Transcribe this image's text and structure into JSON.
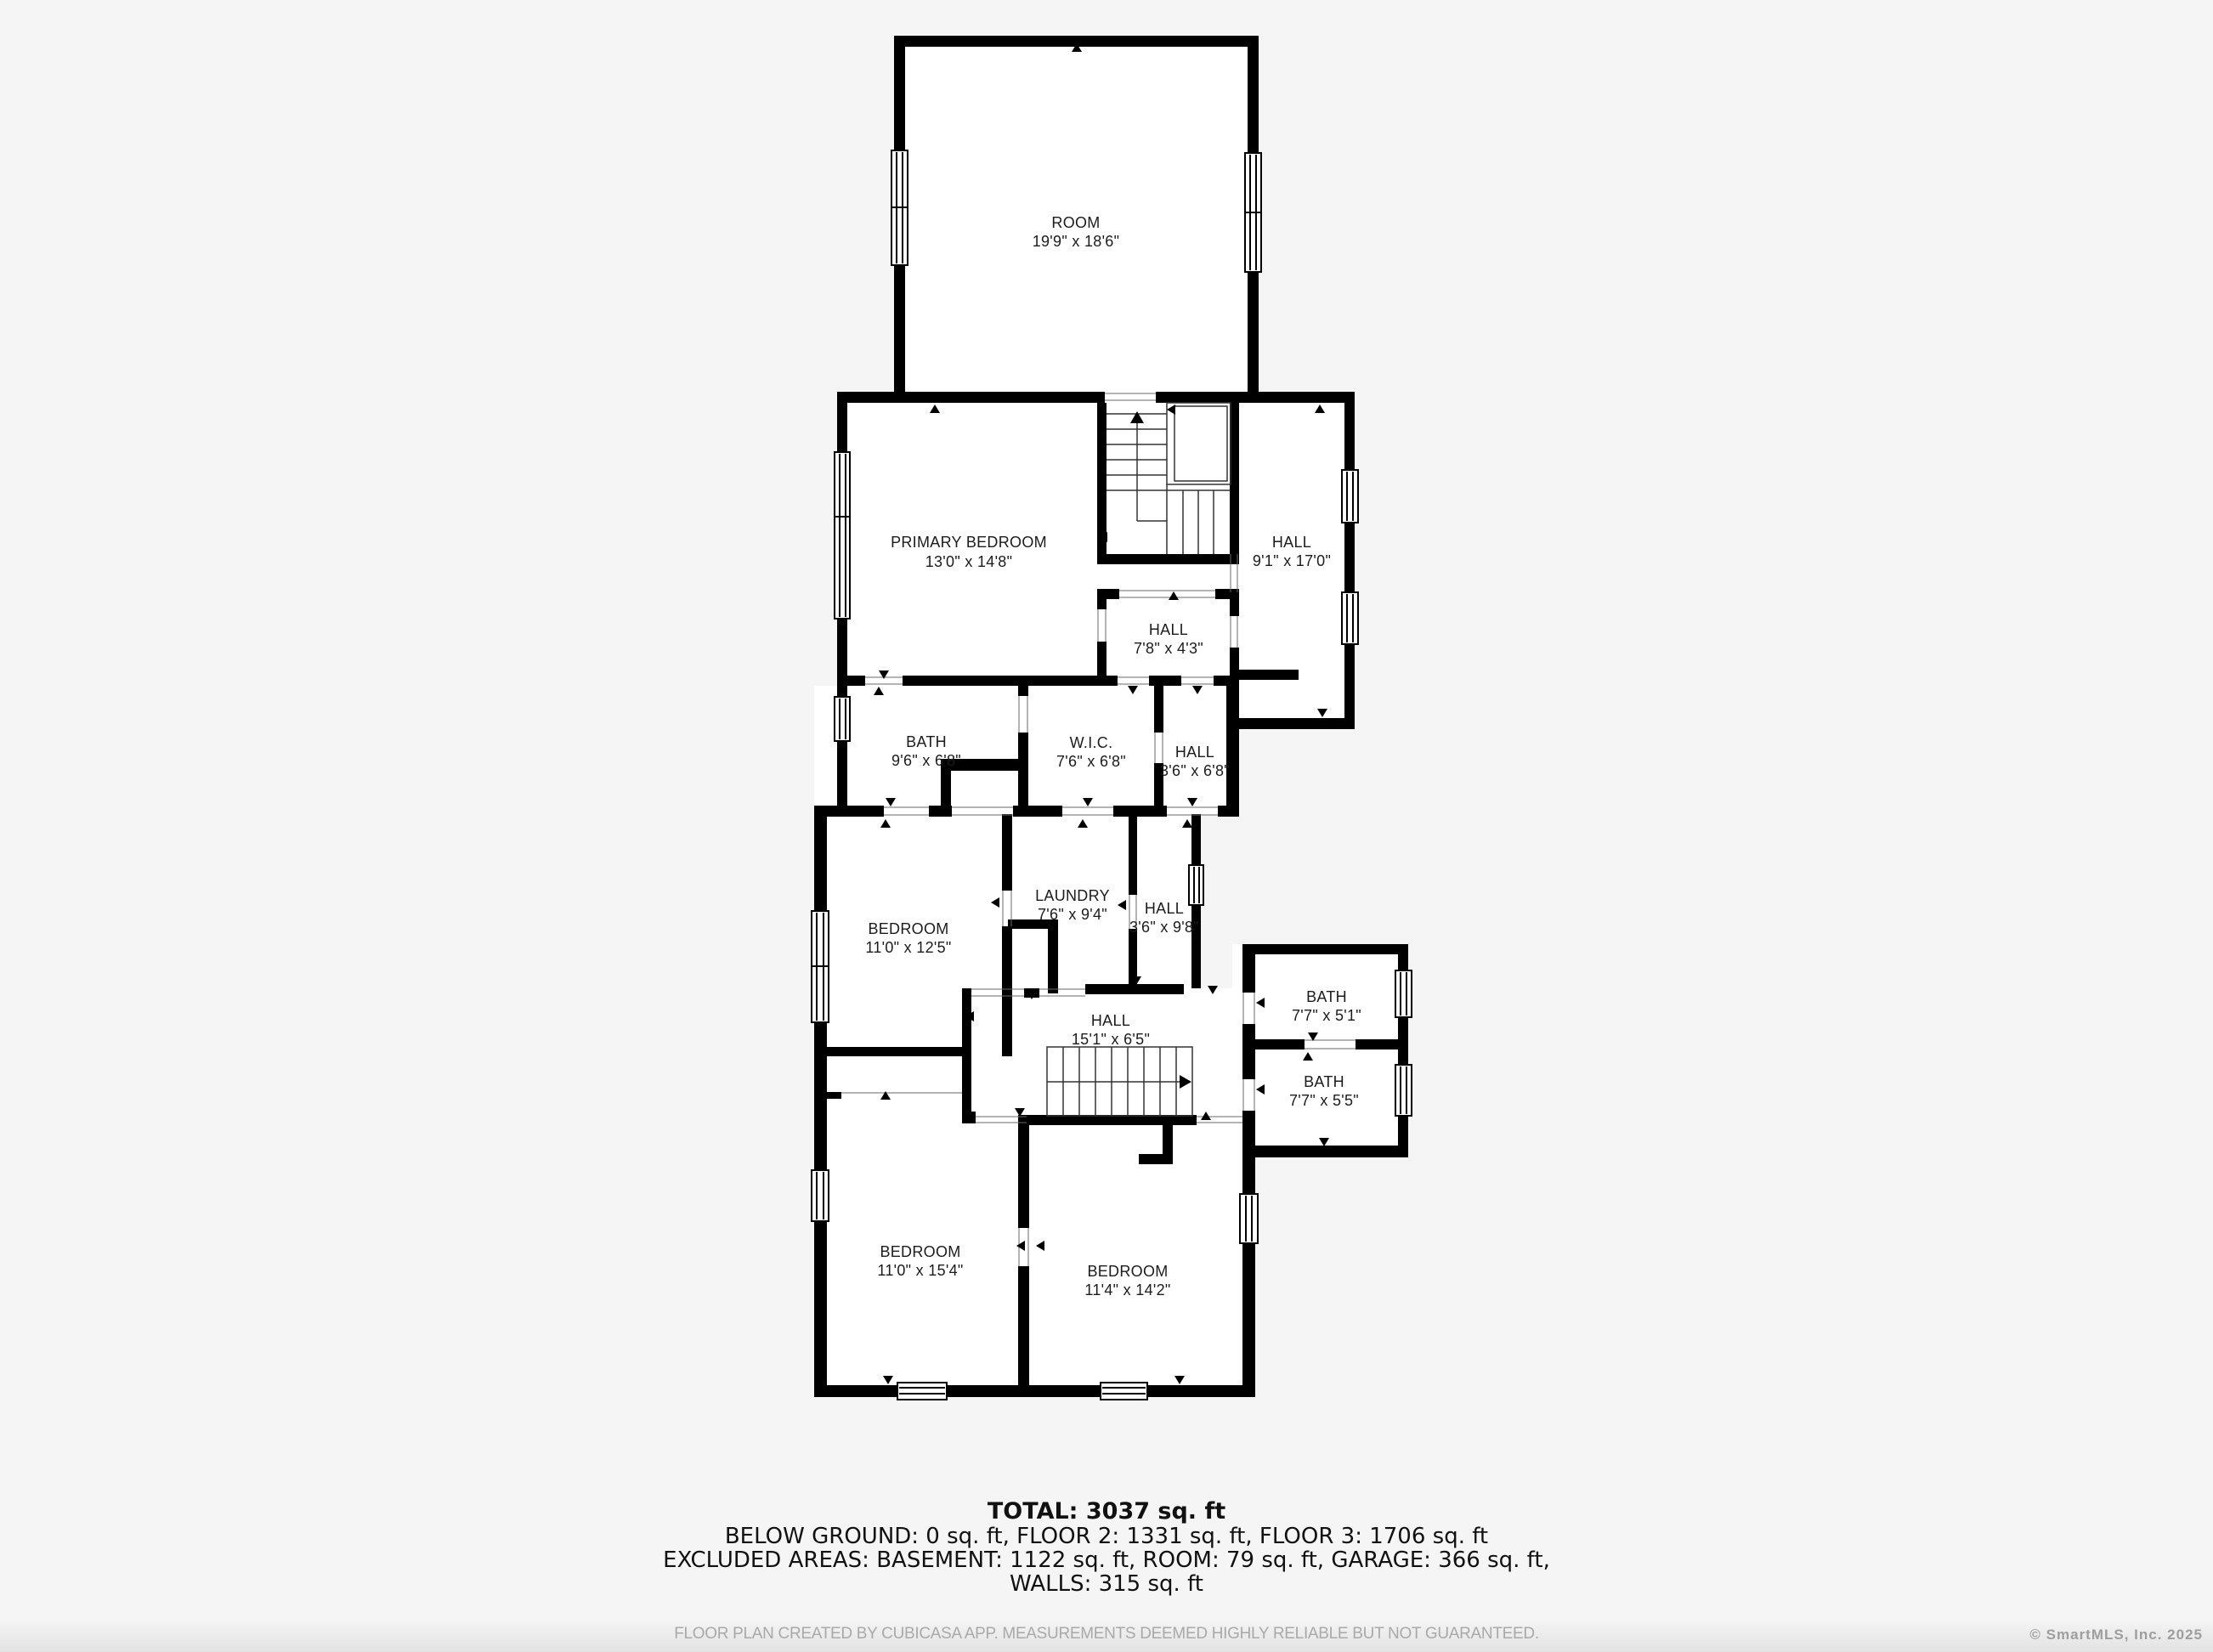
{
  "plan": {
    "rooms": [
      {
        "name": "ROOM",
        "dims": "19'9\" x 18'6\""
      },
      {
        "name": "PRIMARY BEDROOM",
        "dims": "13'0\" x 14'8\""
      },
      {
        "name": "HALL",
        "dims": "9'1\" x 17'0\""
      },
      {
        "name": "HALL",
        "dims": "7'8\" x 4'3\""
      },
      {
        "name": "BATH",
        "dims": "9'6\" x 6'8\""
      },
      {
        "name": "W.I.C.",
        "dims": "7'6\" x 6'8\""
      },
      {
        "name": "HALL",
        "dims": "3'6\" x 6'8\""
      },
      {
        "name": "BEDROOM",
        "dims": "11'0\" x 12'5\""
      },
      {
        "name": "LAUNDRY",
        "dims": "7'6\" x 9'4\""
      },
      {
        "name": "HALL",
        "dims": "3'6\" x 9'8\""
      },
      {
        "name": "BATH",
        "dims": "7'7\" x 5'1\""
      },
      {
        "name": "HALL",
        "dims": "15'1\" x 6'5\""
      },
      {
        "name": "BATH",
        "dims": "7'7\" x 5'5\""
      },
      {
        "name": "BEDROOM",
        "dims": "11'0\" x 15'4\""
      },
      {
        "name": "BEDROOM",
        "dims": "11'4\" x 14'2\""
      }
    ]
  },
  "summary": {
    "total": "TOTAL: 3037 sq. ft",
    "floors": "BELOW GROUND: 0 sq. ft, FLOOR 2: 1331 sq. ft, FLOOR 3: 1706 sq. ft",
    "excluded": "EXCLUDED AREAS: BASEMENT: 1122 sq. ft, ROOM: 79 sq. ft, GARAGE: 366 sq. ft,",
    "walls": "WALLS: 315 sq. ft"
  },
  "footer": {
    "disclaimer": "FLOOR PLAN CREATED BY CUBICASA APP. MEASUREMENTS DEEMED HIGHLY RELIABLE BUT NOT GUARANTEED.",
    "copyright": "© SmartMLS, Inc. 2025"
  },
  "colors": {
    "wall": "#000000",
    "background": "#f5f5f6",
    "room_fill": "#ffffff",
    "label": "#1c1c1c",
    "footer_text": "#a9a9a9"
  }
}
